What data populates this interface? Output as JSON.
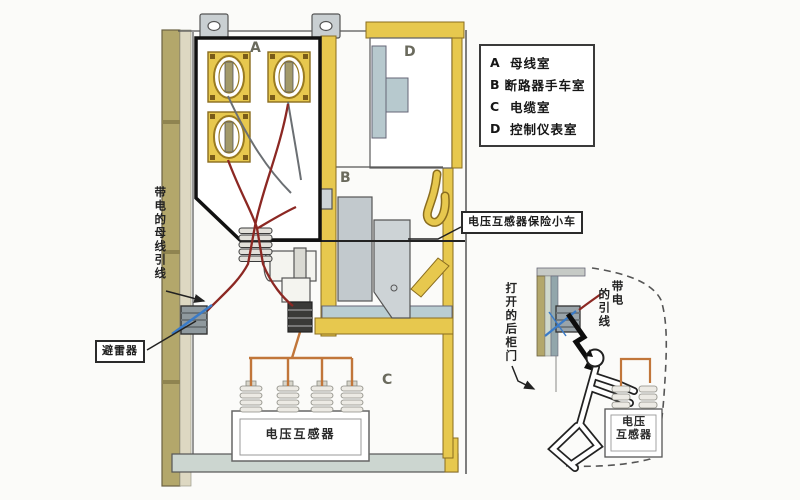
{
  "legend": {
    "items": [
      {
        "key": "A",
        "label": "母线室"
      },
      {
        "key": "B",
        "label": "断路器手车室"
      },
      {
        "key": "C",
        "label": "电缆室"
      },
      {
        "key": "D",
        "label": "控制仪表室"
      }
    ]
  },
  "compartments": {
    "a": "A",
    "b": "B",
    "c": "C",
    "d": "D"
  },
  "labels": {
    "busbar_lead_vertical": "带电的母线引线",
    "arrester": "避雷器",
    "vt_fuse_cart": "电压互感器保险小车",
    "voltage_transformer": "电压互感器"
  },
  "inset": {
    "open_rear_door_vertical": "打开的后柜门",
    "live_lead": {
      "line1": "带电",
      "line2": "的引线"
    },
    "vt_label": {
      "line1": "电压",
      "line2": "互感器"
    }
  },
  "colors": {
    "cabinet_yellow": "#e7c84e",
    "wall_olive": "#b3a76b",
    "panel_blue": "#b7c9ce",
    "metal_gray": "#c2c9cd",
    "wire_red": "#8c2823",
    "wire_orange": "#c1763a",
    "wire_blue": "#3a7bc8"
  }
}
